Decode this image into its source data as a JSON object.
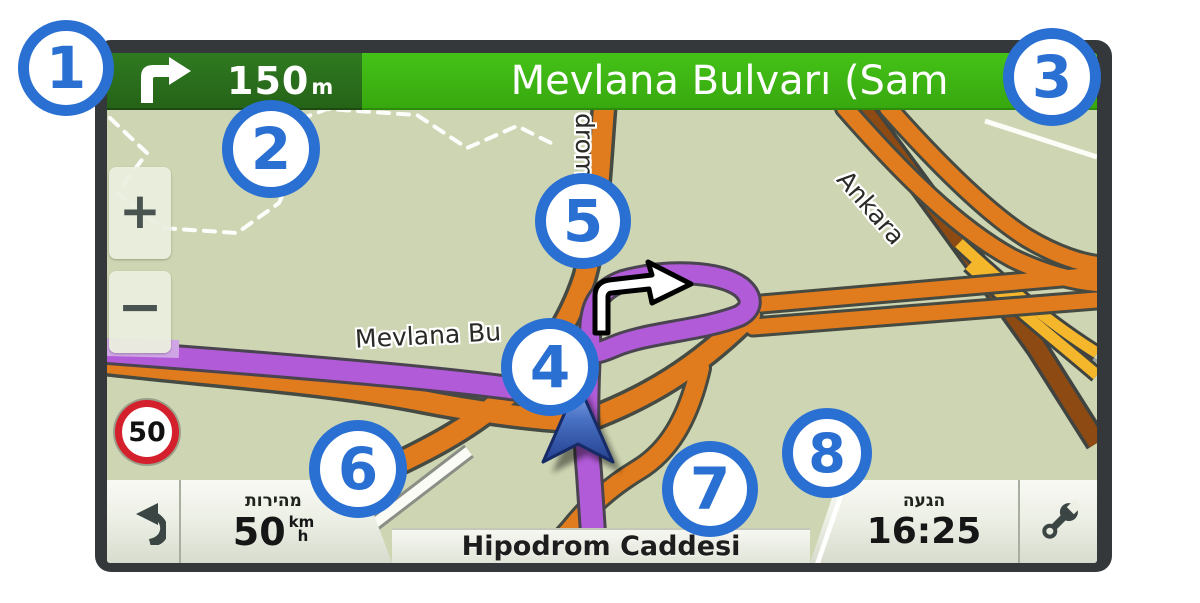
{
  "nav": {
    "maneuver_icon": "turn-right-arrow",
    "distance": "150",
    "distance_unit": "m",
    "street": "Mevlana Bulvarı (Sam"
  },
  "map": {
    "zoom_in": "+",
    "zoom_out": "−",
    "speed_limit": "50",
    "labels": {
      "route": "Mevlana Bu",
      "vertical": "drom",
      "diagonal": "Ankara"
    }
  },
  "status": {
    "speed_label": "מהירות",
    "speed_value": "50",
    "speed_unit_top": "km",
    "speed_unit_bottom": "h",
    "street": "Hipodrom Caddesi",
    "arrival_label": "הגעה",
    "arrival_value": "16:25"
  },
  "callouts": [
    "1",
    "2",
    "3",
    "4",
    "5",
    "6",
    "7",
    "8"
  ],
  "colors": {
    "callout_blue": "#2a6fd2",
    "bar_dark_green": "#256318",
    "bar_green": "#3cb413",
    "route_purple": "#b15bd8",
    "route_purple_light": "#d0a5e6",
    "road_orange": "#e17c1e",
    "road_brown": "#8d4a12",
    "road_yellow": "#f4b62a",
    "sign_red": "#d4202c",
    "map_background": "#cdd5b2"
  }
}
